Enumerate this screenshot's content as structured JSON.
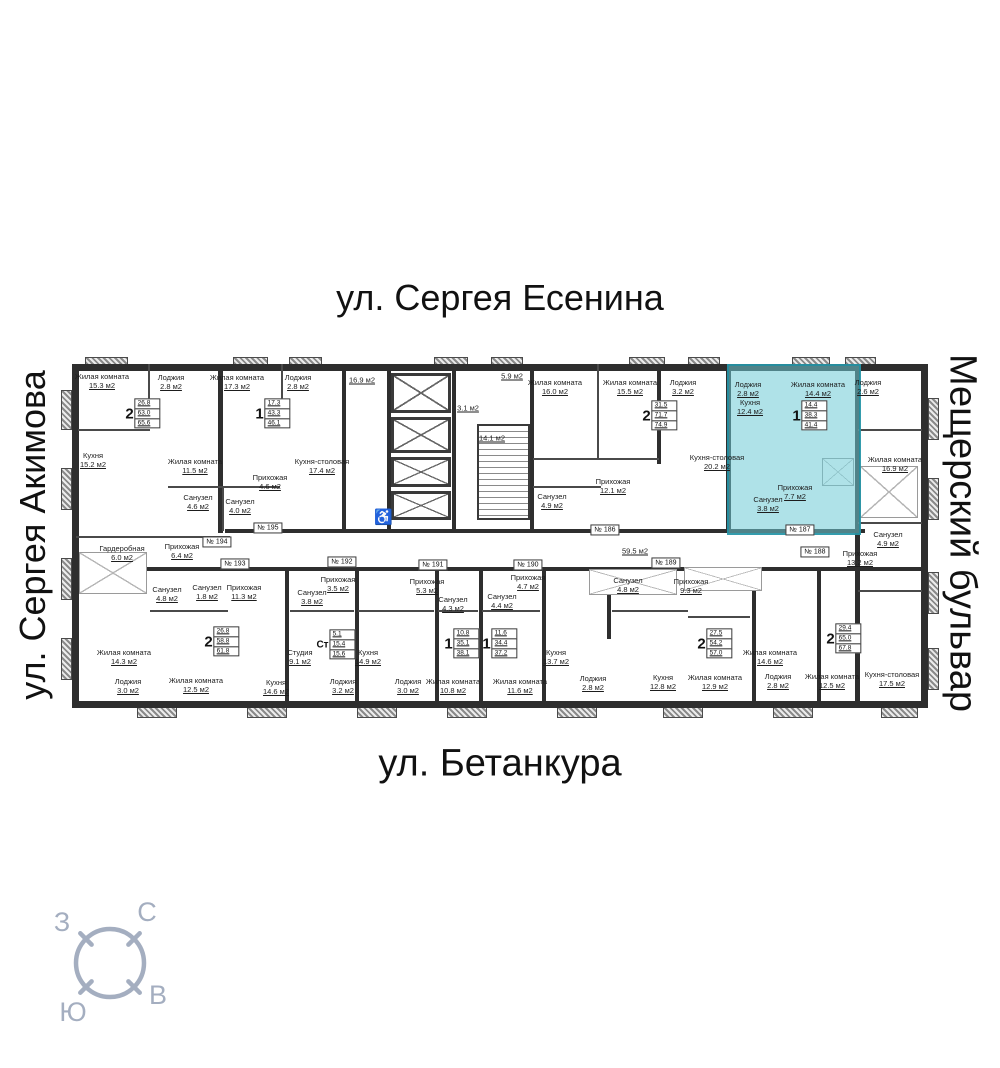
{
  "streets": {
    "top": "ул. Сергея Есенина",
    "bottom": "ул. Бетанкура",
    "left": "ул. Сергея Акимова",
    "right": "Мещерский бульвар"
  },
  "compass": {
    "north": "С",
    "south": "Ю",
    "west": "З",
    "east": "В"
  },
  "colors": {
    "highlight_fill": "#6ecad6",
    "highlight_wall": "#1f8fa2",
    "wall": "#2e2e2e",
    "compass": "#a4aec0",
    "wheelchair": "#9c2b21"
  },
  "plan": {
    "rooms": [
      {
        "n": "Жилая комната",
        "a": "15.3 м2",
        "x": 102,
        "y": 381
      },
      {
        "n": "Лоджия",
        "a": "2.8 м2",
        "x": 171,
        "y": 382
      },
      {
        "n": "Жилая комната",
        "a": "17.3 м2",
        "x": 237,
        "y": 382
      },
      {
        "n": "Лоджия",
        "a": "2.8 м2",
        "x": 298,
        "y": 382
      },
      {
        "n": "Кухня",
        "a": "15.2 м2",
        "x": 93,
        "y": 460
      },
      {
        "n": "Жилая комната",
        "a": "11.5 м2",
        "x": 195,
        "y": 466
      },
      {
        "n": "Санузел",
        "a": "4.6 м2",
        "x": 198,
        "y": 502
      },
      {
        "n": "Санузел",
        "a": "4.0 м2",
        "x": 240,
        "y": 506
      },
      {
        "n": "Прихожая",
        "a": "4.6 м2",
        "x": 270,
        "y": 482
      },
      {
        "n": "Кухня-столовая",
        "a": "17.4 м2",
        "x": 322,
        "y": 466
      },
      {
        "n": "",
        "a": "16.9 м2",
        "x": 362,
        "y": 380
      },
      {
        "n": "",
        "a": "5.9 м2",
        "x": 512,
        "y": 376
      },
      {
        "n": "",
        "a": "3.1 м2",
        "x": 468,
        "y": 408
      },
      {
        "n": "",
        "a": "14.1 м2",
        "x": 492,
        "y": 438
      },
      {
        "n": "Жилая комната",
        "a": "16.0 м2",
        "x": 555,
        "y": 387
      },
      {
        "n": "Жилая комната",
        "a": "15.5 м2",
        "x": 630,
        "y": 387
      },
      {
        "n": "Лоджия",
        "a": "3.2 м2",
        "x": 683,
        "y": 387
      },
      {
        "n": "Кухня-столовая",
        "a": "20.2 м2",
        "x": 717,
        "y": 462
      },
      {
        "n": "Прихожая",
        "a": "12.1 м2",
        "x": 613,
        "y": 486
      },
      {
        "n": "Санузел",
        "a": "4.9 м2",
        "x": 552,
        "y": 501
      },
      {
        "n": "Лоджия",
        "a": "2.8 м2",
        "x": 748,
        "y": 389
      },
      {
        "n": "Жилая комната",
        "a": "14.4 м2",
        "x": 818,
        "y": 389
      },
      {
        "n": "Кухня",
        "a": "12.4 м2",
        "x": 750,
        "y": 407
      },
      {
        "n": "Прихожая",
        "a": "7.7 м2",
        "x": 795,
        "y": 492
      },
      {
        "n": "Санузел",
        "a": "3.8 м2",
        "x": 768,
        "y": 504
      },
      {
        "n": "Лоджия",
        "a": "2.6 м2",
        "x": 868,
        "y": 387
      },
      {
        "n": "Жилая комната",
        "a": "16.9 м2",
        "x": 895,
        "y": 464
      },
      {
        "n": "Санузел",
        "a": "4.9 м2",
        "x": 888,
        "y": 539
      },
      {
        "n": "Прихожая",
        "a": "13.2 м2",
        "x": 860,
        "y": 558
      },
      {
        "n": "Гардеробная",
        "a": "6.0 м2",
        "x": 122,
        "y": 553
      },
      {
        "n": "Прихожая",
        "a": "6.4 м2",
        "x": 182,
        "y": 551
      },
      {
        "n": "Санузел",
        "a": "4.8 м2",
        "x": 167,
        "y": 594
      },
      {
        "n": "Санузел",
        "a": "1.8 м2",
        "x": 207,
        "y": 592
      },
      {
        "n": "Прихожая",
        "a": "11.3 м2",
        "x": 244,
        "y": 592
      },
      {
        "n": "Жилая комната",
        "a": "14.3 м2",
        "x": 124,
        "y": 657
      },
      {
        "n": "Лоджия",
        "a": "3.0 м2",
        "x": 128,
        "y": 686
      },
      {
        "n": "Жилая комната",
        "a": "12.5 м2",
        "x": 196,
        "y": 685
      },
      {
        "n": "Кухня",
        "a": "14.6 м2",
        "x": 276,
        "y": 687
      },
      {
        "n": "Студия",
        "a": "9.1 м2",
        "x": 300,
        "y": 657
      },
      {
        "n": "Санузел",
        "a": "3.8 м2",
        "x": 312,
        "y": 597
      },
      {
        "n": "Прихожая",
        "a": "3.5 м2",
        "x": 338,
        "y": 584
      },
      {
        "n": "Лоджия",
        "a": "3.2 м2",
        "x": 343,
        "y": 686
      },
      {
        "n": "Кухня",
        "a": "14.9 м2",
        "x": 368,
        "y": 657
      },
      {
        "n": "Прихожая",
        "a": "5.3 м2",
        "x": 427,
        "y": 586
      },
      {
        "n": "Лоджия",
        "a": "3.0 м2",
        "x": 408,
        "y": 686
      },
      {
        "n": "Жилая комната",
        "a": "10.8 м2",
        "x": 453,
        "y": 686
      },
      {
        "n": "Санузел",
        "a": "4.3 м2",
        "x": 453,
        "y": 604
      },
      {
        "n": "Санузел",
        "a": "4.4 м2",
        "x": 502,
        "y": 601
      },
      {
        "n": "Прихожая",
        "a": "4.7 м2",
        "x": 528,
        "y": 582
      },
      {
        "n": "Жилая комната",
        "a": "11.6 м2",
        "x": 520,
        "y": 686
      },
      {
        "n": "",
        "a": "59.5 м2",
        "x": 635,
        "y": 551
      },
      {
        "n": "Кухня",
        "a": "13.7 м2",
        "x": 556,
        "y": 657
      },
      {
        "n": "Лоджия",
        "a": "2.8 м2",
        "x": 593,
        "y": 683
      },
      {
        "n": "Санузел",
        "a": "4.8 м2",
        "x": 628,
        "y": 585
      },
      {
        "n": "Прихожая",
        "a": "9.3 м2",
        "x": 691,
        "y": 586
      },
      {
        "n": "Кухня",
        "a": "12.8 м2",
        "x": 663,
        "y": 682
      },
      {
        "n": "Жилая комната",
        "a": "12.9 м2",
        "x": 715,
        "y": 682
      },
      {
        "n": "Жилая комната",
        "a": "14.6 м2",
        "x": 770,
        "y": 657
      },
      {
        "n": "Лоджия",
        "a": "2.8 м2",
        "x": 778,
        "y": 681
      },
      {
        "n": "Жилая комната",
        "a": "12.5 м2",
        "x": 832,
        "y": 681
      },
      {
        "n": "Кухня-столовая",
        "a": "17.5 м2",
        "x": 892,
        "y": 679
      }
    ],
    "apartments": [
      {
        "t": "2",
        "v": [
          "26.8",
          "63.0",
          "65.6"
        ],
        "x": 143,
        "y": 414
      },
      {
        "t": "1",
        "v": [
          "17.3",
          "43.3",
          "46.1"
        ],
        "x": 273,
        "y": 414
      },
      {
        "t": "2",
        "v": [
          "31.5",
          "71.7",
          "74.9"
        ],
        "x": 660,
        "y": 416
      },
      {
        "t": "1",
        "v": [
          "14.4",
          "38.3",
          "41.4"
        ],
        "x": 810,
        "y": 416
      },
      {
        "t": "2",
        "v": [
          "26.8",
          "58.8",
          "61.8"
        ],
        "x": 222,
        "y": 642
      },
      {
        "t": "Ст",
        "v": [
          "5.1",
          "15.4",
          "15.6"
        ],
        "x": 336,
        "y": 645
      },
      {
        "t": "1",
        "v": [
          "10.8",
          "35.1",
          "38.1"
        ],
        "x": 462,
        "y": 644
      },
      {
        "t": "1",
        "v": [
          "11.6",
          "34.4",
          "37.2"
        ],
        "x": 500,
        "y": 644
      },
      {
        "t": "2",
        "v": [
          "27.5",
          "54.2",
          "57.0"
        ],
        "x": 715,
        "y": 644
      },
      {
        "t": "2",
        "v": [
          "29.4",
          "65.0",
          "67.8"
        ],
        "x": 844,
        "y": 639
      }
    ],
    "plates": [
      {
        "label": "№ 186",
        "x": 605,
        "y": 530
      },
      {
        "label": "№ 187",
        "x": 800,
        "y": 530
      },
      {
        "label": "№ 188",
        "x": 815,
        "y": 552
      },
      {
        "label": "№ 189",
        "x": 666,
        "y": 563
      },
      {
        "label": "№ 190",
        "x": 528,
        "y": 565
      },
      {
        "label": "№ 191",
        "x": 433,
        "y": 565
      },
      {
        "label": "№ 192",
        "x": 342,
        "y": 562
      },
      {
        "label": "№ 193",
        "x": 235,
        "y": 564
      },
      {
        "label": "№ 194",
        "x": 217,
        "y": 542
      },
      {
        "label": "№ 195",
        "x": 268,
        "y": 528
      }
    ],
    "wheelchair_icon": "♿"
  }
}
